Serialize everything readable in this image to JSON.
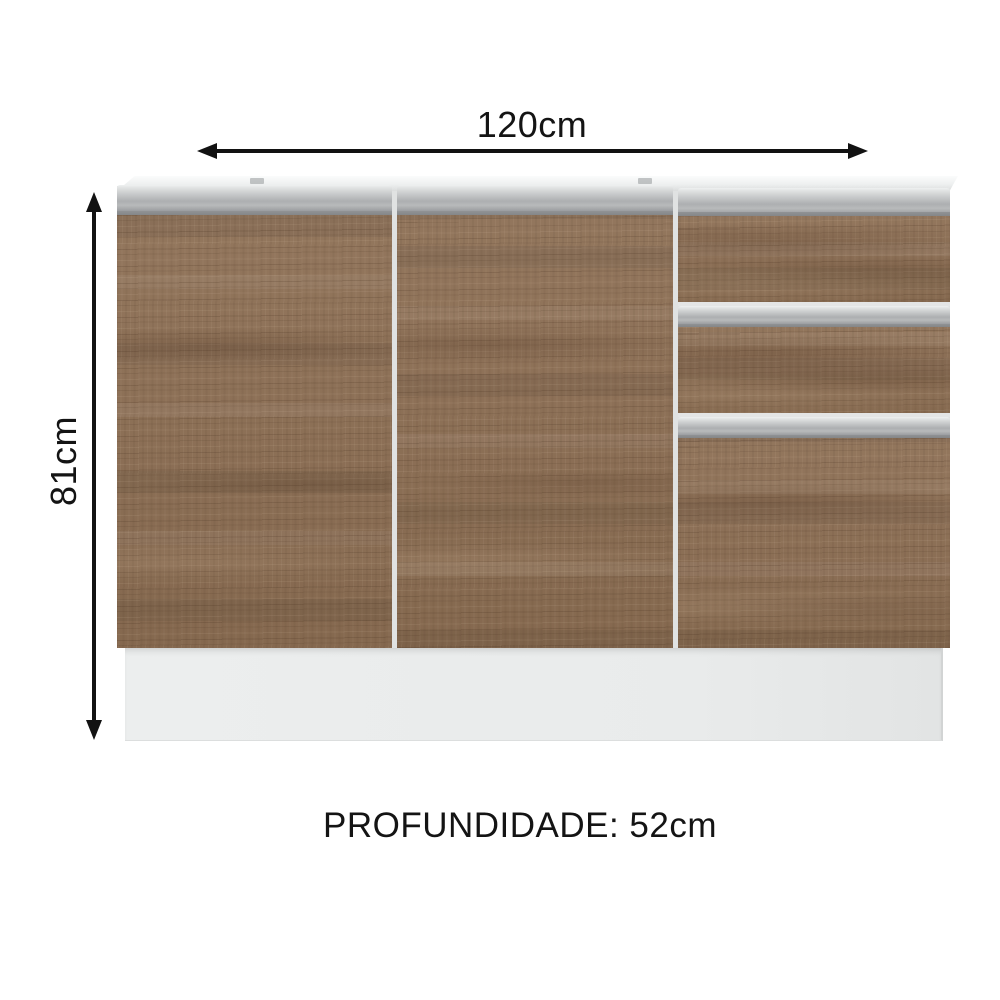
{
  "dimensions": {
    "width_label": "120cm",
    "height_label": "81cm",
    "depth_label": "PROFUNDIDADE: 52cm"
  },
  "cabinet": {
    "sections": [
      {
        "type": "door",
        "position": "left"
      },
      {
        "type": "door",
        "position": "middle"
      },
      {
        "type": "drawer-stack",
        "position": "right",
        "drawer_count": 3
      }
    ],
    "colors": {
      "wood": "#8c6e53",
      "handle_rail": "#b5b7b9",
      "handle_rail_dark": "#8a8c8e",
      "top_rim": "#eef0f0",
      "plinth": "#e9ebeb",
      "arrow": "#121212",
      "background": "#ffffff"
    }
  }
}
